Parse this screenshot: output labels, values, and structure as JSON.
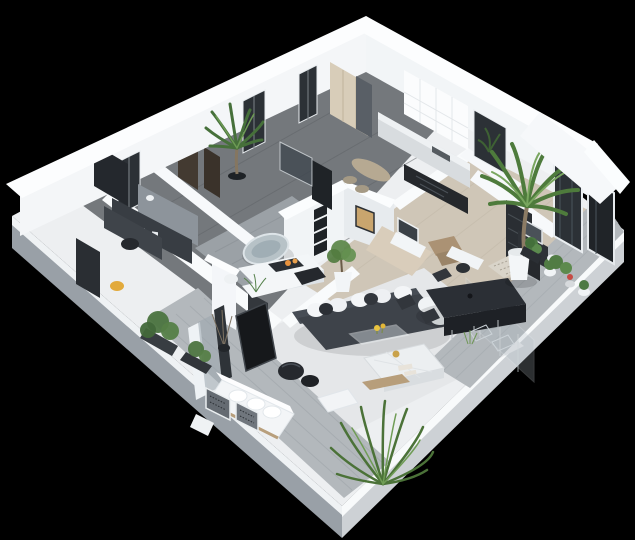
{
  "scene": {
    "type": "3d-isometric-floor-plan-render",
    "description": "Photorealistic 3D isometric cutaway render of a modern apartment floor plan, viewed from above on a solid black background. White walls, gray wood floors, charcoal furniture, green potted palms and ferns.",
    "background_color": "#000000"
  },
  "palette": {
    "background": "#000000",
    "slab_top": "#edeff1",
    "slab_face_left": "#99a0a7",
    "slab_face_right": "#cdd1d5",
    "roof_white": "#fcfdfe",
    "wall_white": "#f4f6f8",
    "floor_wood_dark": "#74787c",
    "floor_wood_light": "#cfc6b7",
    "floor_rug": "#e5e7e9",
    "deck_gray": "#b3b8bc",
    "bath_floor": "#9ba1a6",
    "sofa_dark": "#3e434a",
    "furniture_charcoal": "#2b2f35",
    "cushion_white": "#f3f5f7",
    "marble_white": "#eceff1",
    "tub_gray": "#b7c2c7",
    "window_dark": "#2c3136",
    "plant_green": "#4e7b3c",
    "plant_green_light": "#79a65f",
    "wood_tan": "#ab9274",
    "accent_yellow": "#e2aa3c",
    "accent_orange": "#e8923d",
    "accent_red": "#c64a44",
    "gold": "#c9a24b"
  },
  "rooms": [
    {
      "id": "office-upper",
      "label": "Office / study (upper left)"
    },
    {
      "id": "office-lower",
      "label": "Second office room (left)"
    },
    {
      "id": "hallway",
      "label": "Hallway"
    },
    {
      "id": "kitchen",
      "label": "Kitchen (top center)"
    },
    {
      "id": "bathroom-main",
      "label": "Bathroom with freestanding tub (center)"
    },
    {
      "id": "bathroom-small",
      "label": "Small bathroom with vanity"
    },
    {
      "id": "living-room",
      "label": "Open living room"
    },
    {
      "id": "dining-area",
      "label": "Dining area"
    },
    {
      "id": "entry",
      "label": "Entry with mosaic rug"
    },
    {
      "id": "terrace-south",
      "label": "South terrace deck"
    },
    {
      "id": "terrace-east",
      "label": "East terrace deck"
    },
    {
      "id": "courtyard",
      "label": "Planted courtyard niche"
    }
  ],
  "furniture": [
    {
      "id": "refrigerator",
      "label": "Dark refrigerator unit",
      "room": "office-upper"
    },
    {
      "id": "desk-upper",
      "label": "Dark worktop desk",
      "room": "office-upper"
    },
    {
      "id": "desk-lower",
      "label": "Desk with keyboard and chair",
      "room": "office-lower"
    },
    {
      "id": "wardrobe-door",
      "label": "Dark wardrobe door",
      "room": "office-lower"
    },
    {
      "id": "yellow-stool",
      "label": "Yellow stool",
      "room": "office-lower"
    },
    {
      "id": "kitchen-counter",
      "label": "Kitchen counter with sink",
      "room": "kitchen"
    },
    {
      "id": "cooktop-counter",
      "label": "Glossy black cooktop counter",
      "room": "kitchen"
    },
    {
      "id": "breakfast-table",
      "label": "Small breakfast table with two stools",
      "room": "kitchen"
    },
    {
      "id": "cream-wardrobe",
      "label": "Cream built-in wardrobe",
      "room": "kitchen"
    },
    {
      "id": "freestanding-bathtub",
      "label": "Egg-shaped freestanding bathtub",
      "room": "bathroom-main"
    },
    {
      "id": "vanity-island",
      "label": "White island with fruit tray",
      "room": "bathroom-main"
    },
    {
      "id": "wall-frames",
      "label": "Four stacked dark wall frames",
      "room": "bathroom-main"
    },
    {
      "id": "vanity-mirror",
      "label": "Vanity with mirror",
      "room": "bathroom-small"
    },
    {
      "id": "wooden-steps",
      "label": "Tan wooden step blocks",
      "room": "dining-area"
    },
    {
      "id": "sectional-sofa",
      "label": "Charcoal sectional sofa with white pillows",
      "room": "living-room"
    },
    {
      "id": "marble-ottoman",
      "label": "Quilted marble ottoman table",
      "room": "living-room"
    },
    {
      "id": "glass-coffee-table",
      "label": "Glass side table with yellow flowers",
      "room": "living-room"
    },
    {
      "id": "round-poufs",
      "label": "Two black round poufs",
      "room": "living-room"
    },
    {
      "id": "tv-panel",
      "label": "Flat TV panel",
      "room": "living-room"
    },
    {
      "id": "media-console",
      "label": "White media console",
      "room": "living-room"
    },
    {
      "id": "dining-table",
      "label": "Large charcoal dining table",
      "room": "dining-area"
    },
    {
      "id": "dining-chairs",
      "label": "Six dark dining chairs",
      "room": "dining-area"
    },
    {
      "id": "desk-nook",
      "label": "White desk with dark chair",
      "room": "dining-area"
    },
    {
      "id": "entry-door",
      "label": "Tall charcoal entry door",
      "room": "entry"
    },
    {
      "id": "entry-rug",
      "label": "Beige mosaic tile rug",
      "room": "entry"
    },
    {
      "id": "console-mirror",
      "label": "Dark console with mirror",
      "room": "entry"
    },
    {
      "id": "outdoor-sofa",
      "label": "White outdoor sofa",
      "room": "terrace-south"
    },
    {
      "id": "framed-panels",
      "label": "Leaning framed panels",
      "room": "terrace-south"
    },
    {
      "id": "planter-boxes",
      "label": "Dark planter boxes with shrubs",
      "room": "terrace-south"
    },
    {
      "id": "palm-courtyard",
      "label": "Courtyard palm tree",
      "room": "courtyard"
    },
    {
      "id": "palm-terrace",
      "label": "Large potted palm in white pot",
      "room": "terrace-east"
    },
    {
      "id": "flower-pots",
      "label": "Small flower pots, one red bloom",
      "room": "terrace-east"
    },
    {
      "id": "fern-plant",
      "label": "Large fern at south corner",
      "room": "terrace-south"
    },
    {
      "id": "glass-doors",
      "label": "Floor-to-ceiling dark glass doors",
      "room": "terrace-east"
    },
    {
      "id": "glass-partition",
      "label": "Glass partition by dining area",
      "room": "living-room"
    }
  ]
}
